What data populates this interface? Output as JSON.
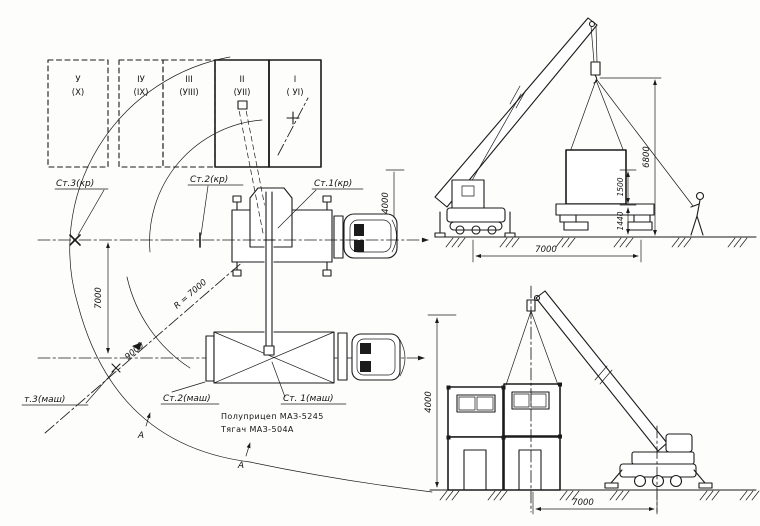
{
  "drawing": {
    "panel_grid": {
      "columns": [
        {
          "roman": "У",
          "alt": "(X)"
        },
        {
          "roman": "IУ",
          "alt": "(IX)"
        },
        {
          "roman": "III",
          "alt": "(УIII)"
        },
        {
          "roman": "II",
          "alt": "(УII)"
        },
        {
          "roman": "I",
          "alt": "( УI)"
        }
      ]
    },
    "plan": {
      "station_crane_3": "Ст.3(кр)",
      "station_crane_2": "Ст.2(кр)",
      "station_crane_1": "Ст.1(кр)",
      "station_machine_3": "т.3(маш)",
      "station_machine_2": "Ст.2(маш)",
      "station_machine_1": "Ст. 1(маш)",
      "radius_label": "R = 7000",
      "dim_offset": "9000",
      "dim_axes_distance": "7000",
      "dim_clearance": "4000",
      "caption_semitrailer": "Полуприцеп МАЗ-5245",
      "caption_tractor": "Тягач МАЗ-504А",
      "section_marker": "А"
    },
    "elevation_loading": {
      "dim_hook_height": "6800",
      "dim_gap": "1500",
      "dim_platform_height": "1440",
      "dim_radius": "7000"
    },
    "elevation_erection": {
      "dim_height": "4000",
      "dim_radius": "7000"
    }
  }
}
